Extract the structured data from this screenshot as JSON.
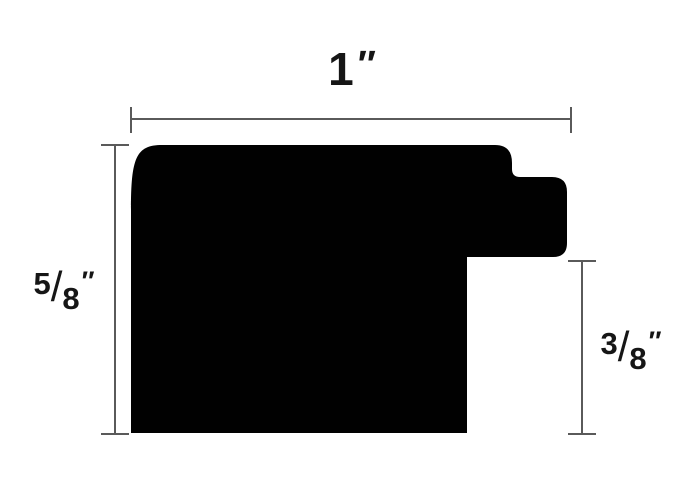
{
  "colors": {
    "background": "#ffffff",
    "shape": "#010101",
    "dimension_line": "#5a5a5a",
    "label_text": "#161616"
  },
  "labels": {
    "width": {
      "value": "1",
      "unit": "″",
      "display": "1″"
    },
    "left_height": {
      "numerator": "5",
      "slash": "/",
      "denominator": "8",
      "unit": "″",
      "display": "5/8″"
    },
    "right_height": {
      "numerator": "3",
      "slash": "/",
      "denominator": "8",
      "unit": "″",
      "display": "3/8″"
    }
  },
  "dimensions": {
    "top": "1 inch overall width",
    "left": "5/8 inch overall height",
    "right": "3/8 inch rabbet height"
  }
}
